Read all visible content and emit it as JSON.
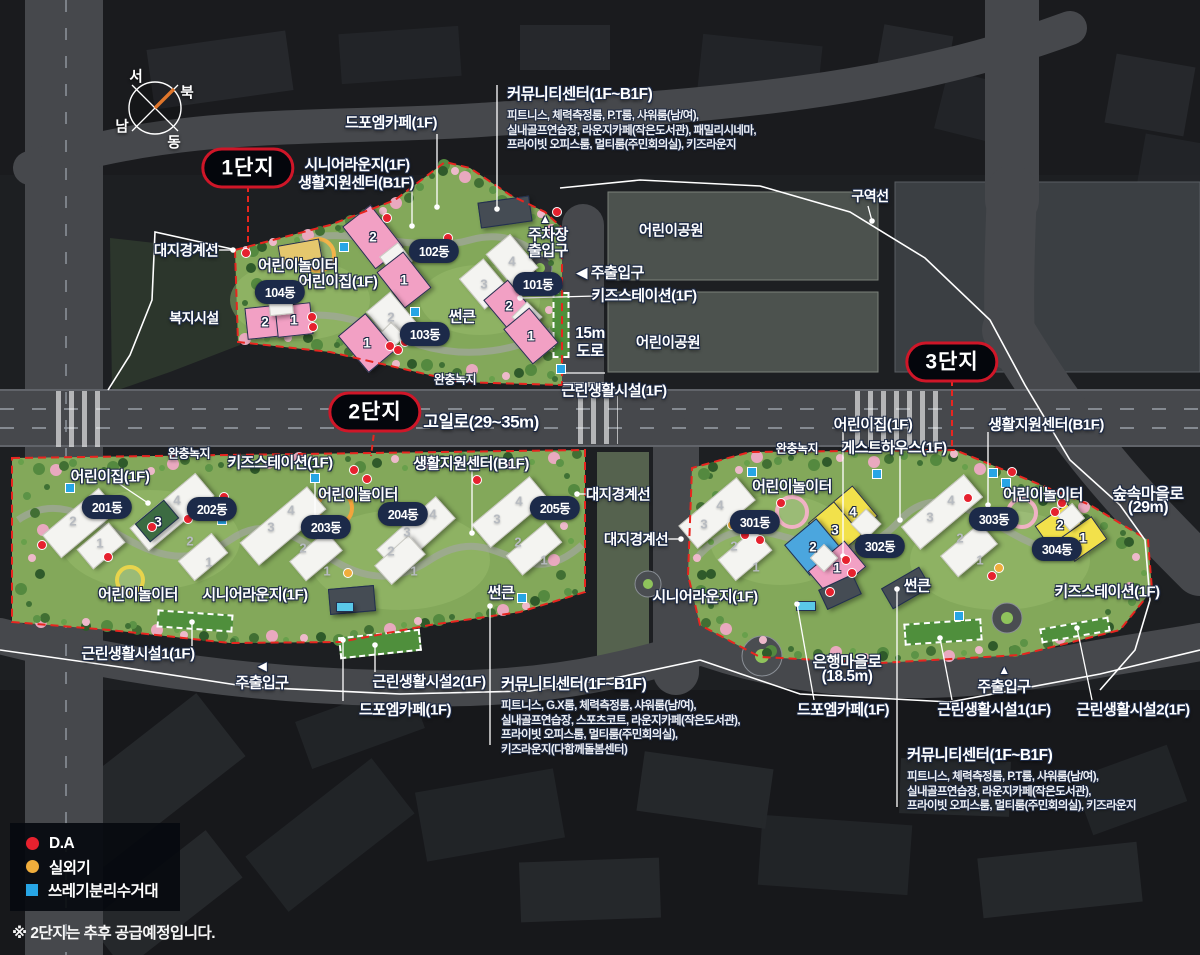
{
  "note": "※ 2단지는 추후 공급예정입니다.",
  "compass": {
    "n": "북",
    "s": "남",
    "e": "동",
    "w": "서"
  },
  "legend": {
    "items": [
      {
        "shape": "circle",
        "color": "#e6212e",
        "label": "D.A"
      },
      {
        "shape": "circle",
        "color": "#f0ad3c",
        "label": "실외기"
      },
      {
        "shape": "square",
        "color": "#27a5e5",
        "label": "쓰레기분리수거대"
      }
    ]
  },
  "sections": [
    {
      "label": "1단지",
      "x": 248,
      "y": 168
    },
    {
      "label": "2단지",
      "x": 375,
      "y": 412
    },
    {
      "label": "3단지",
      "x": 952,
      "y": 362
    }
  ],
  "dongs": [
    {
      "t": "101동",
      "x": 538,
      "y": 284
    },
    {
      "t": "102동",
      "x": 434,
      "y": 251
    },
    {
      "t": "103동",
      "x": 425,
      "y": 334
    },
    {
      "t": "104동",
      "x": 280,
      "y": 292
    },
    {
      "t": "201동",
      "x": 107,
      "y": 507
    },
    {
      "t": "202동",
      "x": 212,
      "y": 509
    },
    {
      "t": "203동",
      "x": 326,
      "y": 527
    },
    {
      "t": "204동",
      "x": 403,
      "y": 514
    },
    {
      "t": "205동",
      "x": 555,
      "y": 508
    },
    {
      "t": "301동",
      "x": 755,
      "y": 522
    },
    {
      "t": "302동",
      "x": 880,
      "y": 546
    },
    {
      "t": "303동",
      "x": 994,
      "y": 519
    },
    {
      "t": "304동",
      "x": 1057,
      "y": 549
    }
  ],
  "labels": [
    {
      "t": "드포엠카페(1F)",
      "x": 391,
      "y": 122,
      "s": 15
    },
    {
      "t": "시니어라운지(1F)",
      "x": 357,
      "y": 164,
      "s": 15
    },
    {
      "t": "생활지원센터(B1F)",
      "x": 356,
      "y": 182,
      "s": 15
    },
    {
      "t": "대지경계선",
      "x": 186,
      "y": 250,
      "s": 14.5
    },
    {
      "t": "어린이놀이터",
      "x": 298,
      "y": 265,
      "s": 15
    },
    {
      "t": "어린이집(1F)",
      "x": 338,
      "y": 281,
      "s": 15
    },
    {
      "t": "복지시설",
      "x": 194,
      "y": 318,
      "s": 14
    },
    {
      "t": "썬큰",
      "x": 462,
      "y": 316,
      "s": 15
    },
    {
      "t": "▲",
      "x": 545,
      "y": 219,
      "s": 12
    },
    {
      "t": "주차장",
      "x": 548,
      "y": 234,
      "s": 15
    },
    {
      "t": "출입구",
      "x": 548,
      "y": 250,
      "s": 15
    },
    {
      "t": "◀ 주출입구",
      "x": 610,
      "y": 272,
      "s": 15
    },
    {
      "t": "키즈스테이션(1F)",
      "x": 644,
      "y": 295,
      "s": 15
    },
    {
      "t": "15m",
      "x": 590,
      "y": 334,
      "s": 15.5
    },
    {
      "t": "도로",
      "x": 590,
      "y": 350,
      "s": 15.5
    },
    {
      "t": "어린이공원",
      "x": 671,
      "y": 230,
      "s": 14.5
    },
    {
      "t": "어린이공원",
      "x": 668,
      "y": 342,
      "s": 14.5
    },
    {
      "t": "근린생활시설(1F)",
      "x": 614,
      "y": 390,
      "s": 15
    },
    {
      "t": "완충녹지",
      "x": 455,
      "y": 379,
      "s": 12
    },
    {
      "t": "완충녹지",
      "x": 189,
      "y": 453,
      "s": 12
    },
    {
      "t": "완충녹지",
      "x": 797,
      "y": 448,
      "s": 12
    },
    {
      "t": "구역선",
      "x": 870,
      "y": 196,
      "s": 14
    },
    {
      "t": "고일로(29~35m)",
      "x": 481,
      "y": 420,
      "s": 17
    },
    {
      "t": "어린이집(1F)",
      "x": 110,
      "y": 476,
      "s": 15
    },
    {
      "t": "키즈스테이션(1F)",
      "x": 280,
      "y": 462,
      "s": 15
    },
    {
      "t": "생활지원센터(B1F)",
      "x": 471,
      "y": 463,
      "s": 15
    },
    {
      "t": "어린이놀이터",
      "x": 358,
      "y": 494,
      "s": 15
    },
    {
      "t": "대지경계선",
      "x": 618,
      "y": 494,
      "s": 14.5
    },
    {
      "t": "대지경계선",
      "x": 636,
      "y": 539,
      "s": 14.5
    },
    {
      "t": "어린이놀이터",
      "x": 138,
      "y": 594,
      "s": 15
    },
    {
      "t": "시니어라운지(1F)",
      "x": 255,
      "y": 594,
      "s": 15
    },
    {
      "t": "썬큰",
      "x": 501,
      "y": 592,
      "s": 15
    },
    {
      "t": "근린생활시설1(1F)",
      "x": 138,
      "y": 653,
      "s": 15
    },
    {
      "t": "◀",
      "x": 262,
      "y": 666,
      "s": 12
    },
    {
      "t": "주출입구",
      "x": 262,
      "y": 682,
      "s": 15
    },
    {
      "t": "근린생활시설2(1F)",
      "x": 429,
      "y": 681,
      "s": 15
    },
    {
      "t": "드포엠카페(1F)",
      "x": 405,
      "y": 709,
      "s": 15
    },
    {
      "t": "어린이집(1F)",
      "x": 873,
      "y": 424,
      "s": 15
    },
    {
      "t": "게스트하우스(1F)",
      "x": 894,
      "y": 447,
      "s": 15
    },
    {
      "t": "생활지원센터(B1F)",
      "x": 1046,
      "y": 424,
      "s": 15
    },
    {
      "t": "어린이놀이터",
      "x": 792,
      "y": 486,
      "s": 15
    },
    {
      "t": "어린이놀이터",
      "x": 1043,
      "y": 494,
      "s": 15
    },
    {
      "t": "숲속마을로",
      "x": 1148,
      "y": 492,
      "s": 16
    },
    {
      "t": "(29m)",
      "x": 1148,
      "y": 508,
      "s": 16
    },
    {
      "t": "시니어라운지(1F)",
      "x": 705,
      "y": 596,
      "s": 15
    },
    {
      "t": "썬큰",
      "x": 917,
      "y": 585,
      "s": 15
    },
    {
      "t": "키즈스테이션(1F)",
      "x": 1107,
      "y": 591,
      "s": 15
    },
    {
      "t": "은행마을로",
      "x": 847,
      "y": 661,
      "s": 15.5
    },
    {
      "t": "(18.5m)",
      "x": 847,
      "y": 677,
      "s": 15.5
    },
    {
      "t": "▲",
      "x": 1004,
      "y": 670,
      "s": 12
    },
    {
      "t": "주출입구",
      "x": 1004,
      "y": 686,
      "s": 15
    },
    {
      "t": "드포엠카페(1F)",
      "x": 843,
      "y": 709,
      "s": 15
    },
    {
      "t": "근린생활시설1(1F)",
      "x": 994,
      "y": 709,
      "s": 15
    },
    {
      "t": "근린생활시설2(1F)",
      "x": 1133,
      "y": 709,
      "s": 15
    }
  ],
  "info_blocks": [
    {
      "title": "커뮤니티센터(1F~B1F)",
      "x": 507,
      "y": 82,
      "lines": [
        "피트니스, 체력측정룸, P.T룸, 샤워룸(남/여),",
        "실내골프연습장, 라운지카페(작은도서관), 패밀리시네마,",
        "프라이빗 오피스룸, 멀티룸(주민회의실), 키즈라운지"
      ]
    },
    {
      "title": "커뮤니티센터(1F~B1F)",
      "x": 501,
      "y": 672,
      "lines": [
        "피트니스, G.X룸, 체력측정룸, 샤워룸(남/여),",
        "실내골프연습장, 스포츠코트, 라운지카페(작은도서관),",
        "프라이빗 오피스룸, 멀티룸(주민회의실),",
        "키즈라운지(다함께돌봄센터)"
      ]
    },
    {
      "title": "커뮤니티센터(1F~B1F)",
      "x": 907,
      "y": 743,
      "lines": [
        "피트니스, 체력측정룸, P.T룸, 샤워룸(남/여),",
        "실내골프연습장, 라운지카페(작은도서관),",
        "프라이빗 오피스룸, 멀티룸(주민회의실), 키즈라운지"
      ]
    }
  ],
  "markers": {
    "da": [
      [
        246,
        253
      ],
      [
        387,
        218
      ],
      [
        448,
        238
      ],
      [
        557,
        212
      ],
      [
        312,
        317
      ],
      [
        313,
        327
      ],
      [
        390,
        346
      ],
      [
        398,
        350
      ],
      [
        405,
        342
      ],
      [
        42,
        545
      ],
      [
        108,
        557
      ],
      [
        152,
        527
      ],
      [
        188,
        519
      ],
      [
        224,
        497
      ],
      [
        354,
        470
      ],
      [
        367,
        479
      ],
      [
        477,
        480
      ],
      [
        745,
        535
      ],
      [
        760,
        540
      ],
      [
        781,
        503
      ],
      [
        968,
        498
      ],
      [
        1012,
        472
      ],
      [
        1055,
        512
      ],
      [
        1062,
        503
      ],
      [
        992,
        576
      ],
      [
        846,
        560
      ],
      [
        852,
        573
      ],
      [
        830,
        592
      ]
    ],
    "ac": [
      [
        348,
        573
      ],
      [
        732,
        525
      ],
      [
        999,
        568
      ]
    ],
    "trash": [
      [
        344,
        247
      ],
      [
        415,
        312
      ],
      [
        561,
        369
      ],
      [
        70,
        488
      ],
      [
        222,
        520
      ],
      [
        315,
        478
      ],
      [
        522,
        598
      ],
      [
        752,
        472
      ],
      [
        877,
        474
      ],
      [
        993,
        473
      ],
      [
        1006,
        483
      ],
      [
        959,
        616
      ]
    ]
  },
  "unit_numbers": [
    {
      "n": "2",
      "x": 373,
      "y": 237,
      "c": "w"
    },
    {
      "n": "1",
      "x": 404,
      "y": 280,
      "c": "w"
    },
    {
      "n": "2",
      "x": 265,
      "y": 322,
      "c": "w"
    },
    {
      "n": "1",
      "x": 294,
      "y": 320,
      "c": "w"
    },
    {
      "n": "2",
      "x": 391,
      "y": 317,
      "c": "g"
    },
    {
      "n": "1",
      "x": 367,
      "y": 343,
      "c": "w"
    },
    {
      "n": "4",
      "x": 512,
      "y": 261,
      "c": "g"
    },
    {
      "n": "3",
      "x": 484,
      "y": 284,
      "c": "g"
    },
    {
      "n": "2",
      "x": 509,
      "y": 306,
      "c": "w"
    },
    {
      "n": "1",
      "x": 531,
      "y": 336,
      "c": "w"
    },
    {
      "n": "2",
      "x": 73,
      "y": 521,
      "c": "g"
    },
    {
      "n": "1",
      "x": 100,
      "y": 543,
      "c": "g"
    },
    {
      "n": "4",
      "x": 177,
      "y": 500,
      "c": "g"
    },
    {
      "n": "3",
      "x": 158,
      "y": 522,
      "c": "w"
    },
    {
      "n": "2",
      "x": 190,
      "y": 541,
      "c": "g"
    },
    {
      "n": "1",
      "x": 209,
      "y": 562,
      "c": "g"
    },
    {
      "n": "4",
      "x": 291,
      "y": 510,
      "c": "g"
    },
    {
      "n": "3",
      "x": 271,
      "y": 527,
      "c": "g"
    },
    {
      "n": "2",
      "x": 303,
      "y": 548,
      "c": "g"
    },
    {
      "n": "1",
      "x": 327,
      "y": 571,
      "c": "g"
    },
    {
      "n": "4",
      "x": 433,
      "y": 514,
      "c": "g"
    },
    {
      "n": "3",
      "x": 407,
      "y": 532,
      "c": "g"
    },
    {
      "n": "2",
      "x": 391,
      "y": 551,
      "c": "g"
    },
    {
      "n": "1",
      "x": 414,
      "y": 571,
      "c": "g"
    },
    {
      "n": "4",
      "x": 519,
      "y": 501,
      "c": "g"
    },
    {
      "n": "3",
      "x": 497,
      "y": 519,
      "c": "g"
    },
    {
      "n": "2",
      "x": 518,
      "y": 542,
      "c": "g"
    },
    {
      "n": "1",
      "x": 544,
      "y": 560,
      "c": "g"
    },
    {
      "n": "4",
      "x": 720,
      "y": 505,
      "c": "g"
    },
    {
      "n": "3",
      "x": 704,
      "y": 524,
      "c": "g"
    },
    {
      "n": "2",
      "x": 734,
      "y": 546,
      "c": "g"
    },
    {
      "n": "1",
      "x": 756,
      "y": 567,
      "c": "g"
    },
    {
      "n": "4",
      "x": 853,
      "y": 512,
      "c": "w"
    },
    {
      "n": "3",
      "x": 835,
      "y": 530,
      "c": "w"
    },
    {
      "n": "2",
      "x": 813,
      "y": 547,
      "c": "w"
    },
    {
      "n": "1",
      "x": 837,
      "y": 568,
      "c": "w"
    },
    {
      "n": "4",
      "x": 951,
      "y": 500,
      "c": "g"
    },
    {
      "n": "3",
      "x": 930,
      "y": 517,
      "c": "g"
    },
    {
      "n": "2",
      "x": 960,
      "y": 538,
      "c": "g"
    },
    {
      "n": "1",
      "x": 980,
      "y": 560,
      "c": "g"
    },
    {
      "n": "2",
      "x": 1060,
      "y": 525,
      "c": "w"
    },
    {
      "n": "1",
      "x": 1083,
      "y": 538,
      "c": "w"
    }
  ]
}
